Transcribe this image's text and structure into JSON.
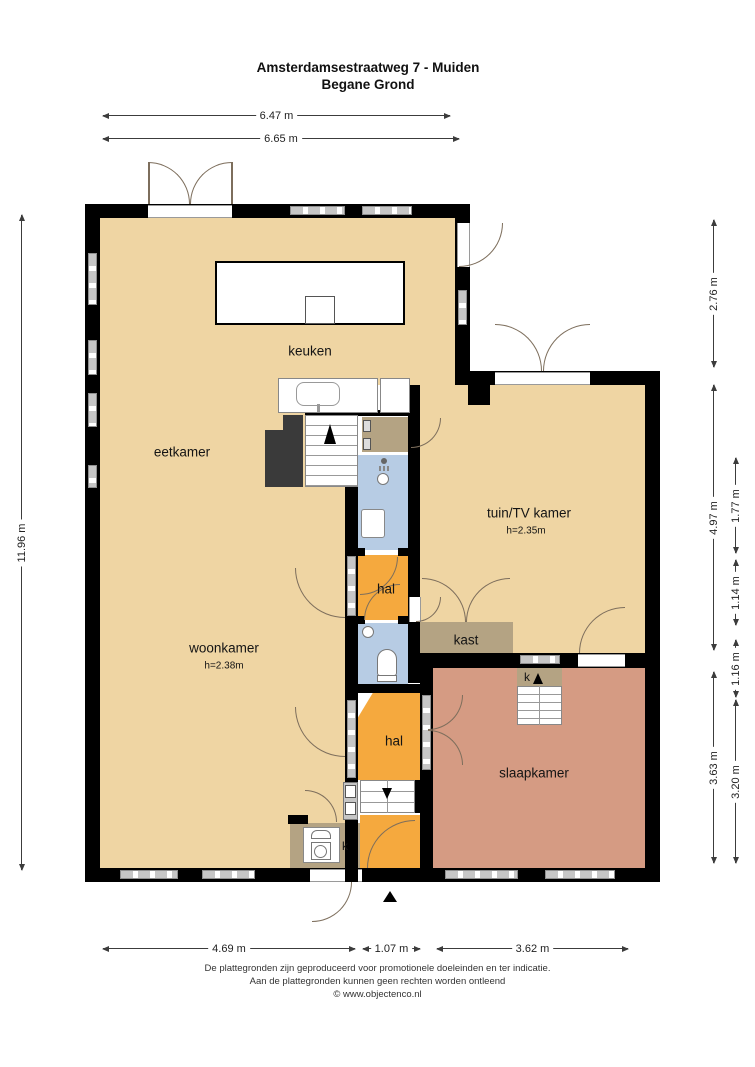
{
  "title": {
    "line1": "Amsterdamsestraatweg 7 - Muiden",
    "line2": "Begane Grond"
  },
  "rooms": {
    "keuken": {
      "label": "keuken"
    },
    "eetkamer": {
      "label": "eetkamer"
    },
    "woonkamer": {
      "label": "woonkamer",
      "height": "h=2.38m"
    },
    "tuin_tv_kamer": {
      "label": "tuin/TV kamer",
      "height": "h=2.35m"
    },
    "hal1": {
      "label": "hal"
    },
    "hal2": {
      "label": "hal"
    },
    "kast": {
      "label": "kast"
    },
    "slaapkamer": {
      "label": "slaapkamer"
    },
    "k_room": {
      "label": "k"
    },
    "k_closet": {
      "label": "k"
    }
  },
  "dims": {
    "top": [
      {
        "label": "6.47 m"
      },
      {
        "label": "6.65 m"
      }
    ],
    "left": [
      {
        "label": "11.96 m"
      }
    ],
    "right": [
      {
        "label": "2.76 m"
      },
      {
        "label": "4.97 m"
      },
      {
        "label": "3.63 m"
      },
      {
        "label": "1.77 m"
      },
      {
        "label": "1.14 m"
      },
      {
        "label": "1.16 m"
      },
      {
        "label": "3.20 m"
      }
    ],
    "bottom": [
      {
        "label": "4.69 m"
      },
      {
        "label": "1.07 m"
      },
      {
        "label": "3.62 m"
      }
    ]
  },
  "footer": {
    "line1": "De plattegronden zijn geproduceerd voor promotionele doeleinden en ter indicatie.",
    "line2": "Aan de plattegronden kunnen geen rechten worden ontleend",
    "line3": "© www.objectenco.nl"
  },
  "colors": {
    "floor_tan": "#efd5a3",
    "hal_orange": "#f5a93e",
    "bath_blue": "#b7cce4",
    "closet_khaki": "#b4a383",
    "bedroom_salmon": "#d59b83",
    "wall_black": "#000000",
    "window_gray": "#c6c6c6"
  }
}
